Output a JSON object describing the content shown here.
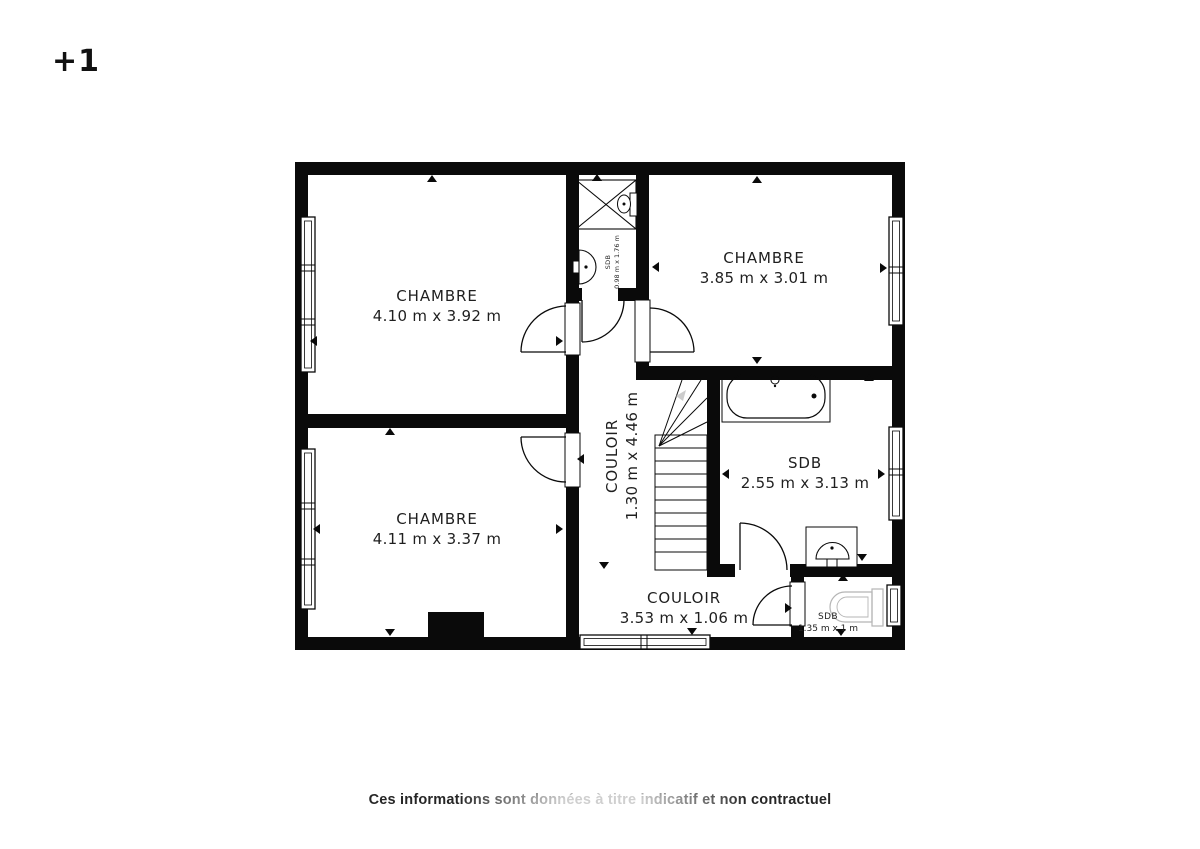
{
  "floor_label": "+1",
  "disclaimer": "Ces informations sont données à titre indicatif et non contractuel",
  "rooms": [
    {
      "name": "CHAMBRE",
      "dims": "4.10 m x 3.92 m"
    },
    {
      "name": "CHAMBRE",
      "dims": "3.85 m x 3.01 m"
    },
    {
      "name": "CHAMBRE",
      "dims": "4.11 m x 3.37 m"
    },
    {
      "name": "SDB",
      "dims": "2.55 m x 3.13 m"
    },
    {
      "name": "COULOIR",
      "dims": "1.30 m x 4.46 m"
    },
    {
      "name": "COULOIR",
      "dims": "3.53 m x 1.06 m"
    },
    {
      "name": "SDB",
      "dims": "0.98 m x 1.76 m"
    },
    {
      "name": "SDB",
      "dims": "1.35 m x 1 m"
    }
  ]
}
